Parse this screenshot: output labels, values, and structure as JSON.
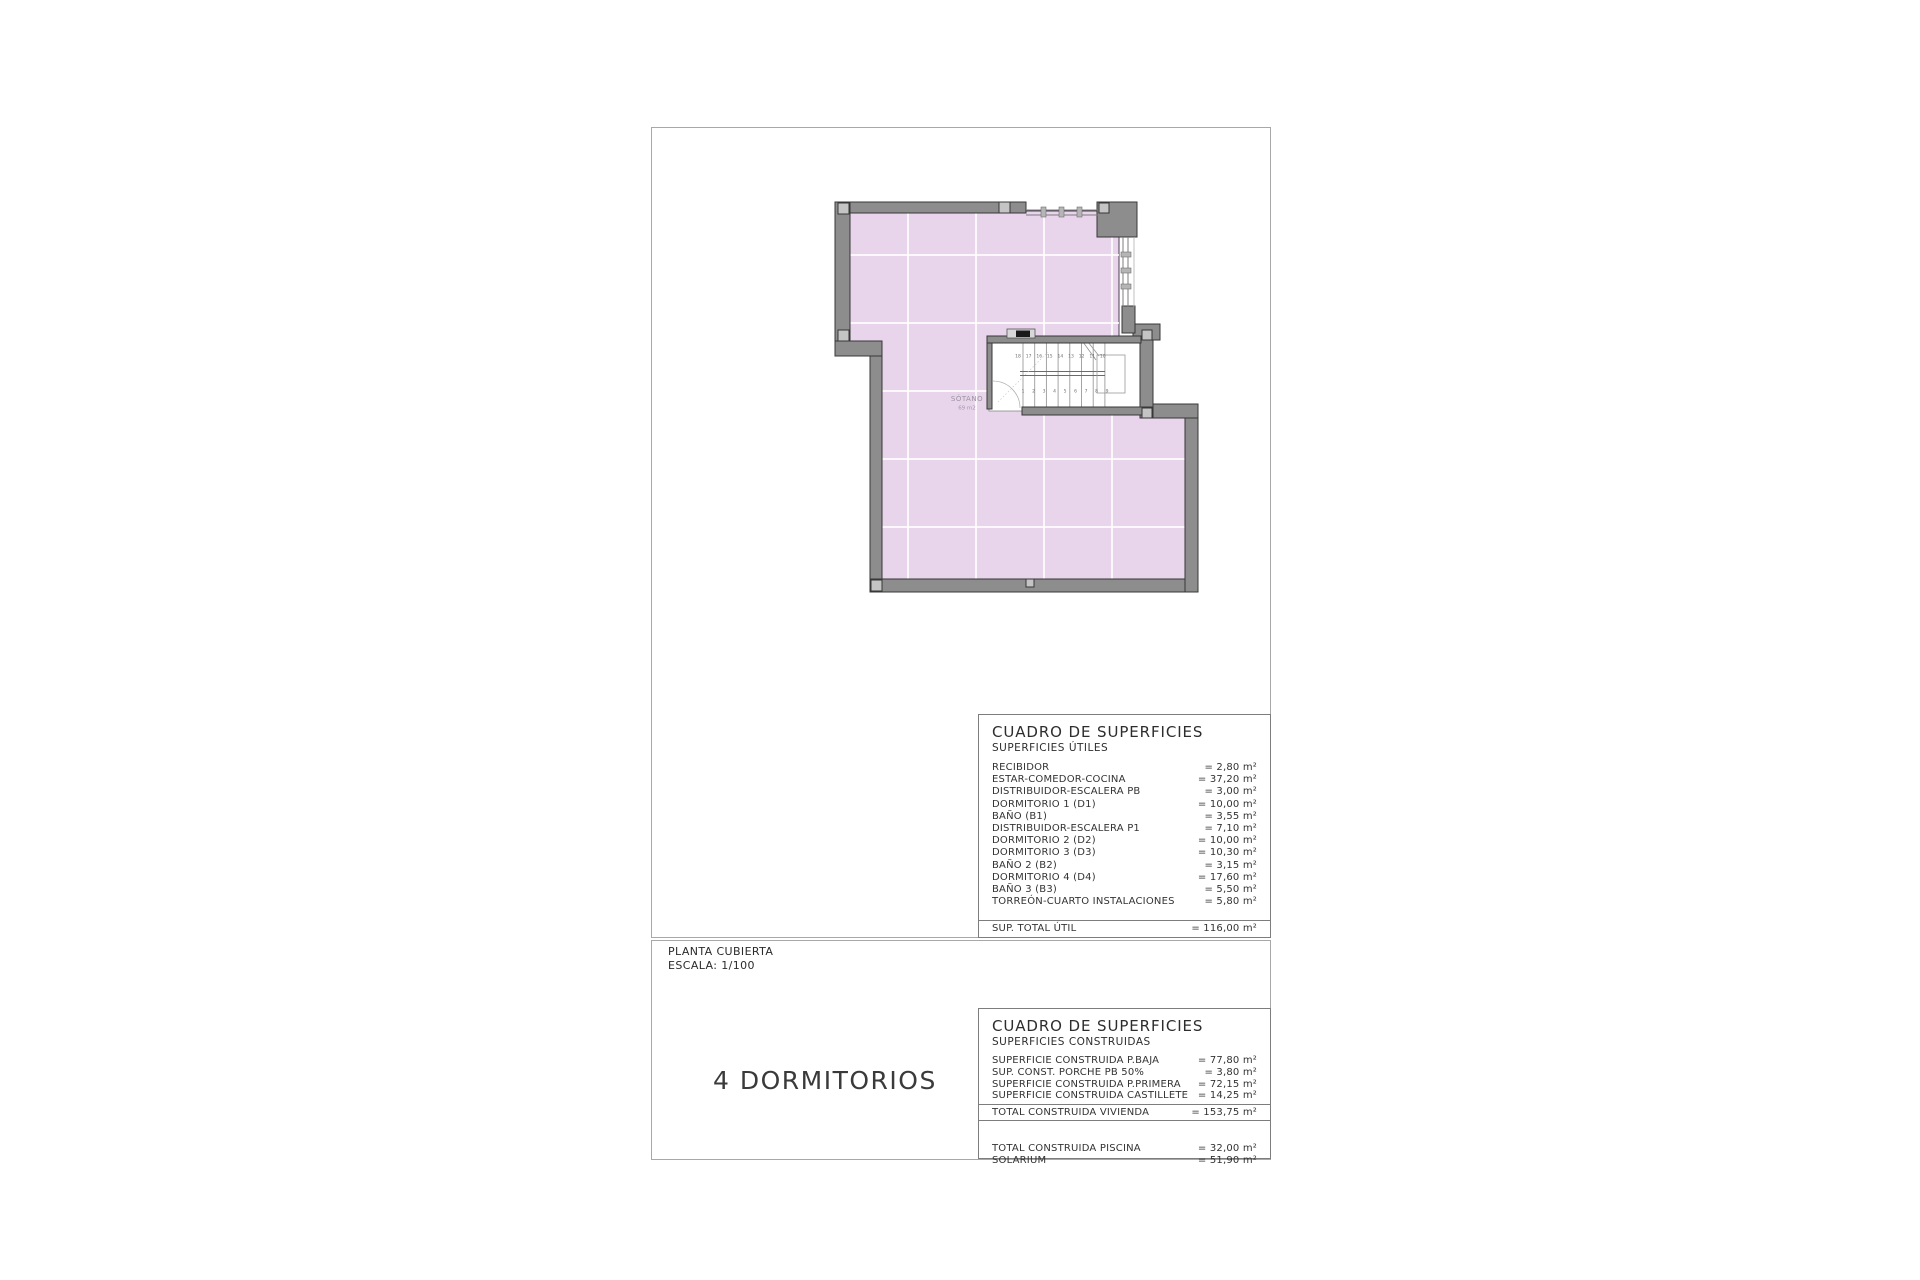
{
  "title_block": {
    "plan_name": "PLANTA CUBIERTA",
    "scale": "ESCALA: 1/100",
    "bedrooms": "4 DORMITORIOS"
  },
  "plan": {
    "room_label": "SÓTANO",
    "room_area": "69 m2",
    "stair_numbers_upper": [
      "18",
      "17",
      "16",
      "15",
      "14",
      "13",
      "12",
      "11",
      "10"
    ],
    "stair_numbers_lower": [
      "1",
      "2",
      "3",
      "4",
      "5",
      "6",
      "7",
      "8",
      "9"
    ],
    "colors": {
      "wall": "#8d8d8d",
      "wall_edge": "#383838",
      "floor": "#e8d4eb",
      "pillar": "#c4c4c4"
    }
  },
  "tables": {
    "useful": {
      "title": "CUADRO DE SUPERFICIES",
      "subtitle": "SUPERFICIES ÚTILES",
      "rows": [
        {
          "label": "RECIBIDOR",
          "value": "= 2,80 m²"
        },
        {
          "label": "ESTAR-COMEDOR-COCINA",
          "value": "= 37,20 m²"
        },
        {
          "label": "DISTRIBUIDOR-ESCALERA PB",
          "value": "= 3,00 m²"
        },
        {
          "label": "DORMITORIO 1 (D1)",
          "value": "= 10,00 m²"
        },
        {
          "label": "BAÑO (B1)",
          "value": "= 3,55 m²"
        },
        {
          "label": "DISTRIBUIDOR-ESCALERA P1",
          "value": "= 7,10 m²"
        },
        {
          "label": "DORMITORIO 2 (D2)",
          "value": "= 10,00 m²"
        },
        {
          "label": "DORMITORIO 3 (D3)",
          "value": "= 10,30 m²"
        },
        {
          "label": "BAÑO 2 (B2)",
          "value": "= 3,15 m²"
        },
        {
          "label": "DORMITORIO 4 (D4)",
          "value": "= 17,60 m²"
        },
        {
          "label": "BAÑO 3 (B3)",
          "value": "= 5,50 m²"
        },
        {
          "label": "TORREÓN-CUARTO INSTALACIONES",
          "value": "= 5,80 m²"
        }
      ],
      "total": {
        "label": "SUP. TOTAL ÚTIL",
        "value": "= 116,00 m²"
      }
    },
    "built": {
      "title": "CUADRO DE SUPERFICIES",
      "subtitle": "SUPERFICIES CONSTRUIDAS",
      "rows": [
        {
          "label": "SUPERFICIE  CONSTRUIDA P.BAJA",
          "value": "= 77,80 m²"
        },
        {
          "label": "SUP. CONST. PORCHE PB 50%",
          "value": "= 3,80 m²"
        },
        {
          "label": "SUPERFICIE CONSTRUIDA P.PRIMERA",
          "value": "= 72,15 m²"
        },
        {
          "label": "SUPERFICIE CONSTRUIDA CASTILLETE",
          "value": "= 14,25 m²"
        }
      ],
      "total": {
        "label": "TOTAL CONSTRUIDA VIVIENDA",
        "value": "= 153,75 m²"
      },
      "extra_rows": [
        {
          "label": "TOTAL CONSTRUIDA PISCINA",
          "value": "= 32,00 m²"
        },
        {
          "label": "SOLARIUM",
          "value": "= 51,90 m²"
        }
      ]
    }
  }
}
